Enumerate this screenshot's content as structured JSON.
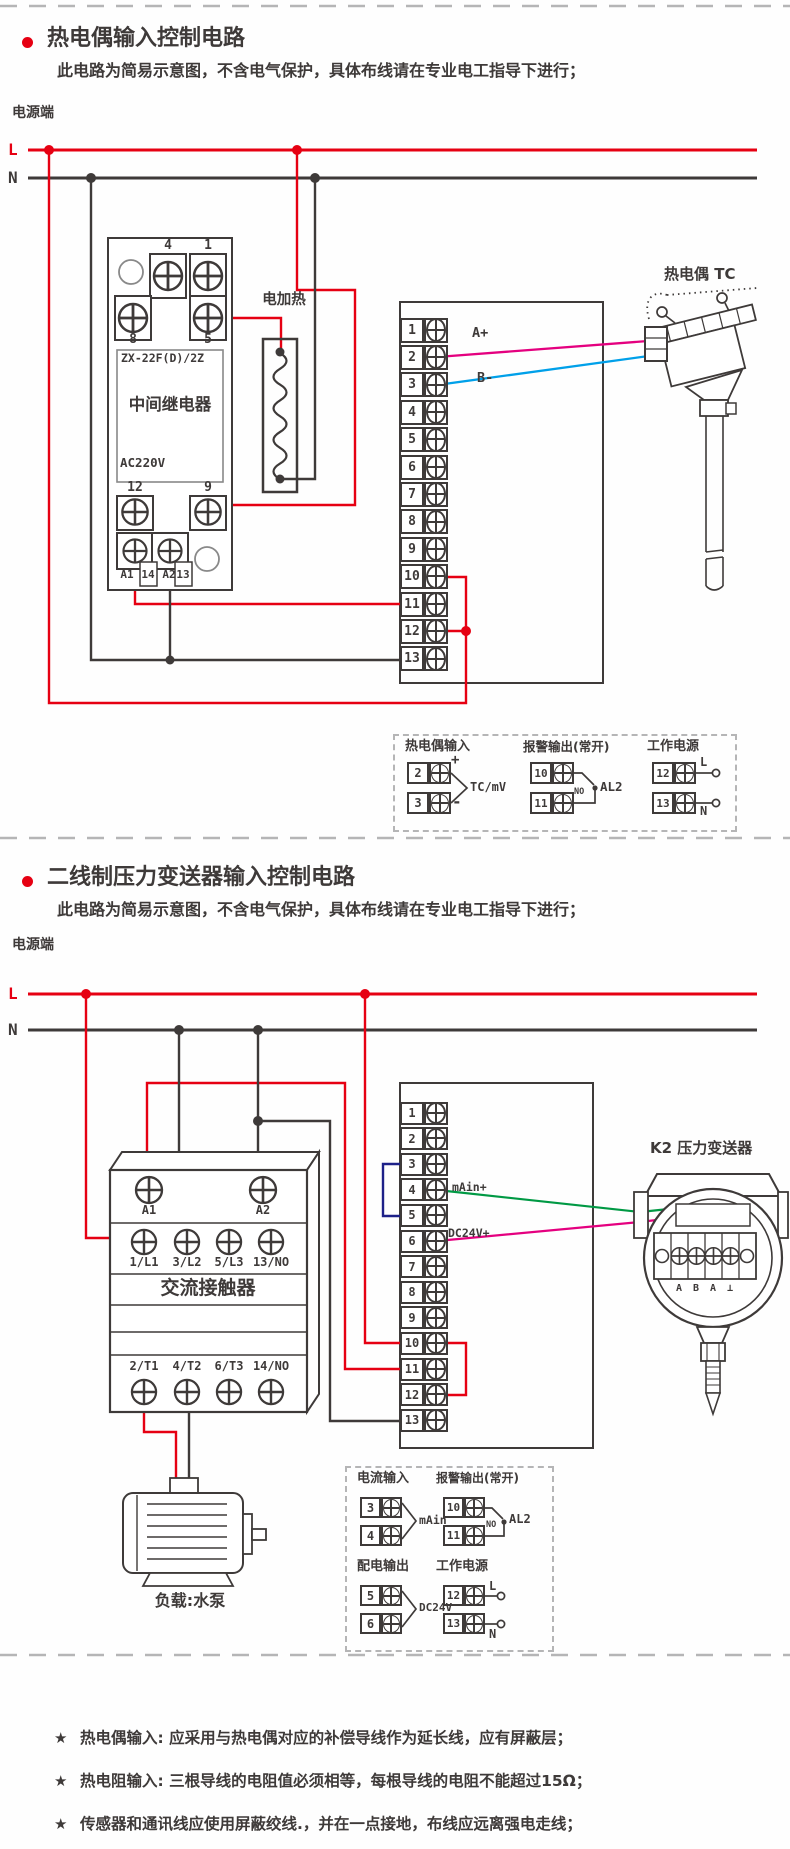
{
  "section1": {
    "title": "热电偶输入控制电路",
    "subtitle": "此电路为简易示意图，不含电气保护，具体布线请在专业电工指导下进行；",
    "power_label": "电源端",
    "line_l": "L",
    "line_n": "N",
    "relay": {
      "top": [
        "4",
        "1"
      ],
      "mid": [
        "8",
        "5"
      ],
      "model": "ZX-22F(D)/2Z",
      "name": "中间继电器",
      "voltage": "AC220V",
      "low": [
        "12",
        "9"
      ],
      "coil": [
        "A1",
        "14",
        "A2",
        "13"
      ]
    },
    "heater_label": "电加热",
    "tc_label": "热电偶 TC",
    "a_plus": "A+",
    "b_minus": "B-",
    "strip_terminals": [
      "1",
      "2",
      "3",
      "4",
      "5",
      "6",
      "7",
      "8",
      "9",
      "10",
      "11",
      "12",
      "13"
    ],
    "legend": {
      "tc": {
        "title": "热电偶输入",
        "t1": "2",
        "t2": "3",
        "plus": "+",
        "minus": "-",
        "signal": "TC/mV"
      },
      "alarm": {
        "title": "报警输出(常开)",
        "t1": "10",
        "t2": "11",
        "no": "NO",
        "name": "AL2"
      },
      "power": {
        "title": "工作电源",
        "t1": "12",
        "t2": "13",
        "l": "L",
        "n": "N"
      }
    }
  },
  "section2": {
    "title": "二线制压力变送器输入控制电路",
    "subtitle": "此电路为简易示意图，不含电气保护，具体布线请在专业电工指导下进行；",
    "power_label": "电源端",
    "line_l": "L",
    "line_n": "N",
    "contactor": {
      "coil": [
        "A1",
        "A2"
      ],
      "inputs": [
        "1/L1",
        "3/L2",
        "5/L3",
        "13/NO"
      ],
      "name": "交流接触器",
      "outputs": [
        "2/T1",
        "4/T2",
        "6/T3",
        "14/NO"
      ]
    },
    "motor_label": "负载:水泵",
    "transmitter": {
      "label": "K2 压力变送器",
      "terminals": [
        "A",
        "B",
        "A",
        "⊥"
      ]
    },
    "ma_in": "mAin+",
    "dc24": "DC24V+",
    "strip_terminals": [
      "1",
      "2",
      "3",
      "4",
      "5",
      "6",
      "7",
      "8",
      "9",
      "10",
      "11",
      "12",
      "13"
    ],
    "legend": {
      "current": {
        "title": "电流输入",
        "t1": "3",
        "t2": "4",
        "signal": "mAin"
      },
      "alarm": {
        "title": "报警输出(常开)",
        "t1": "10",
        "t2": "11",
        "no": "NO",
        "name": "AL2"
      },
      "dist": {
        "title": "配电输出",
        "t1": "5",
        "t2": "6",
        "signal": "DC24V"
      },
      "power": {
        "title": "工作电源",
        "t1": "12",
        "t2": "13",
        "l": "L",
        "n": "N"
      }
    }
  },
  "notes": {
    "star": "★",
    "items": [
      "热电偶输入: 应采用与热电偶对应的补偿导线作为延长线，应有屏蔽层；",
      "热电阻输入: 三根导线的电阻值必须相等，每根导线的电阻不能超过15Ω；",
      "传感器和通讯线应使用屏蔽绞线.，并在一点接地，布线应远离强电走线；"
    ]
  },
  "colors": {
    "red": "#e60012",
    "line": "#3e3a39",
    "magenta": "#e4007f",
    "cyan": "#00a0e9",
    "green": "#009944",
    "navy": "#1d2088",
    "dash": "#b5b5b6"
  }
}
